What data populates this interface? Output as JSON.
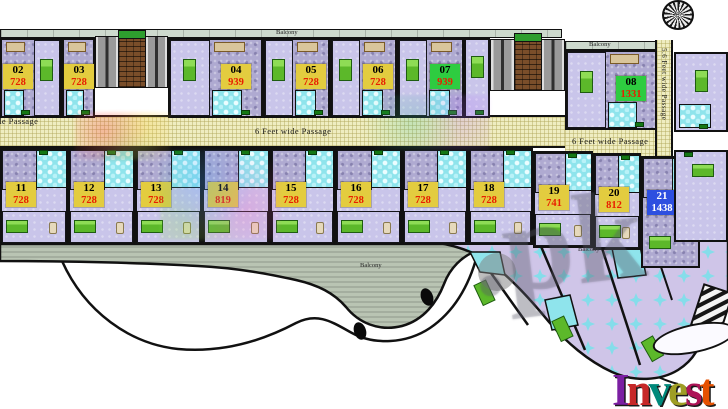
{
  "plan": {
    "passage_label_left": "6 Feet wide Passage",
    "passage_label_center": "6 Feet wide Passage",
    "passage_label_right": "6 Feet wide Passage",
    "passage_label_vertical": "5.6 Feet wide Passage",
    "balcony_top_left": "Balcony",
    "balcony_top_right": "Balcony",
    "balcony_bottom_center": "Balcony",
    "balcony_bottom_right": "Balcony"
  },
  "units_top": [
    {
      "number": "02",
      "area": "728",
      "label_color": "yellow"
    },
    {
      "number": "03",
      "area": "728",
      "label_color": "yellow"
    },
    {
      "number": "04",
      "area": "939",
      "label_color": "yellow"
    },
    {
      "number": "05",
      "area": "728",
      "label_color": "yellow"
    },
    {
      "number": "06",
      "area": "728",
      "label_color": "yellow"
    },
    {
      "number": "07",
      "area": "939",
      "label_color": "green"
    },
    {
      "number": "08",
      "area": "1331",
      "label_color": "green"
    }
  ],
  "units_bottom": [
    {
      "number": "11",
      "area": "728",
      "label_color": "yellow"
    },
    {
      "number": "12",
      "area": "728",
      "label_color": "yellow"
    },
    {
      "number": "13",
      "area": "728",
      "label_color": "yellow"
    },
    {
      "number": "14",
      "area": "819",
      "label_color": "yellow"
    },
    {
      "number": "15",
      "area": "728",
      "label_color": "yellow"
    },
    {
      "number": "16",
      "area": "728",
      "label_color": "yellow"
    },
    {
      "number": "17",
      "area": "728",
      "label_color": "yellow"
    },
    {
      "number": "18",
      "area": "728",
      "label_color": "yellow"
    },
    {
      "number": "19",
      "area": "741",
      "label_color": "yellow"
    },
    {
      "number": "20",
      "area": "812",
      "label_color": "yellow"
    },
    {
      "number": "21",
      "area": "1438",
      "label_color": "blue"
    }
  ],
  "watermark": {
    "text": ".pk"
  },
  "logo": {
    "text": "Invest"
  },
  "colors": {
    "label_yellow": "#e3cc3f",
    "label_green": "#2ecc40",
    "label_blue": "#2d4fe0",
    "area_text": "#e81f00",
    "area_text_light": "#ffffff",
    "passage_bg": "#efedc1",
    "balcony_bg": "#b9c4b3",
    "floor_lavender": "#c9c5ea",
    "floor_mottled": "#afaad1",
    "bath_cyan": "#8fe4ec",
    "bed_green": "#5cb82a",
    "wall": "#111111"
  }
}
